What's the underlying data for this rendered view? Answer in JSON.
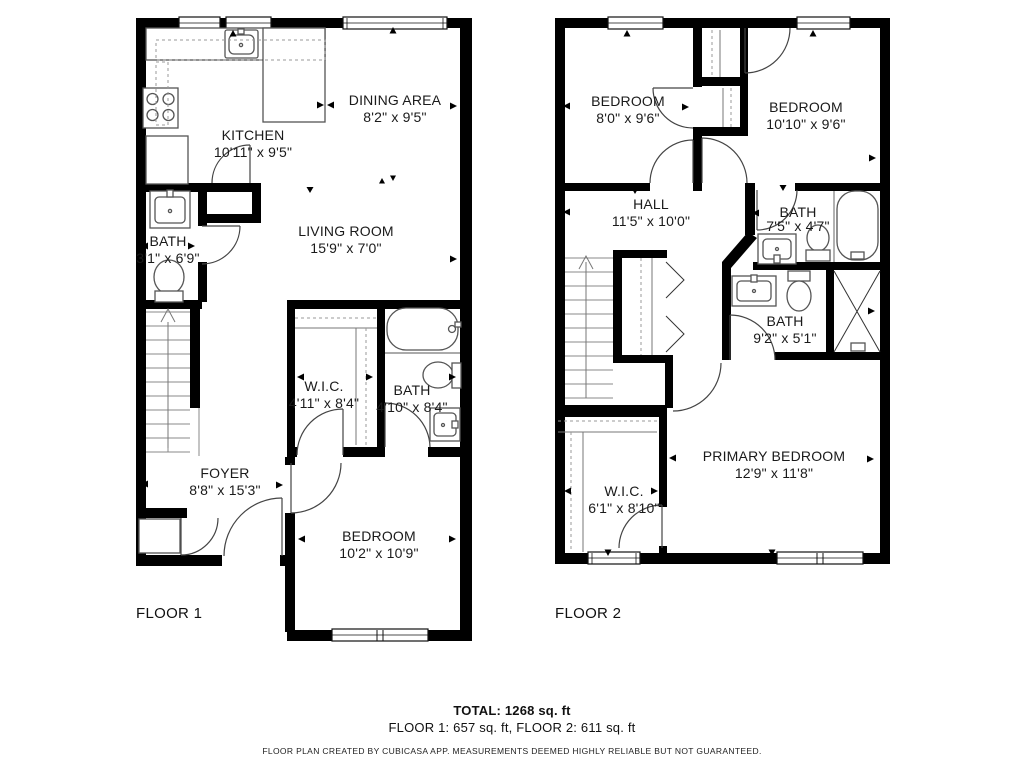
{
  "colors": {
    "wall": "#000000",
    "fixture_line": "#555555",
    "door_line": "#444444",
    "dashed_line": "#999999",
    "text": "#1a1a1a"
  },
  "floor1": {
    "label": "FLOOR 1",
    "rooms": {
      "kitchen": {
        "name": "KITCHEN",
        "dims": "10'11\" x 9'5\""
      },
      "dining": {
        "name": "DINING AREA",
        "dims": "8'2\" x 9'5\""
      },
      "living": {
        "name": "LIVING ROOM",
        "dims": "15'9\" x 7'0\""
      },
      "bath": {
        "name": "BATH",
        "dims": "3'1\" x 6'9\""
      },
      "wic": {
        "name": "W.I.C.",
        "dims": "4'11\" x 8'4\""
      },
      "bath2": {
        "name": "BATH",
        "dims": "4'10\" x 8'4\""
      },
      "foyer": {
        "name": "FOYER",
        "dims": "8'8\" x 15'3\""
      },
      "bedroom": {
        "name": "BEDROOM",
        "dims": "10'2\" x 10'9\""
      }
    }
  },
  "floor2": {
    "label": "FLOOR 2",
    "rooms": {
      "bedroom_left": {
        "name": "BEDROOM",
        "dims": "8'0\" x 9'6\""
      },
      "bedroom_right": {
        "name": "BEDROOM",
        "dims": "10'10\" x 9'6\""
      },
      "hall": {
        "name": "HALL",
        "dims": "11'5\" x 10'0\""
      },
      "bath_upper": {
        "name": "BATH",
        "dims": "7'5\" x 4'7\""
      },
      "bath_lower": {
        "name": "BATH",
        "dims": "9'2\" x 5'1\""
      },
      "primary": {
        "name": "PRIMARY BEDROOM",
        "dims": "12'9\" x 11'8\""
      },
      "wic": {
        "name": "W.I.C.",
        "dims": "6'1\" x 8'10\""
      }
    }
  },
  "footer": {
    "total": "TOTAL: 1268 sq. ft",
    "breakdown": "FLOOR 1: 657 sq. ft, FLOOR 2: 611 sq. ft",
    "disclaimer": "FLOOR PLAN CREATED BY CUBICASA APP. MEASUREMENTS DEEMED HIGHLY RELIABLE BUT NOT GUARANTEED."
  }
}
